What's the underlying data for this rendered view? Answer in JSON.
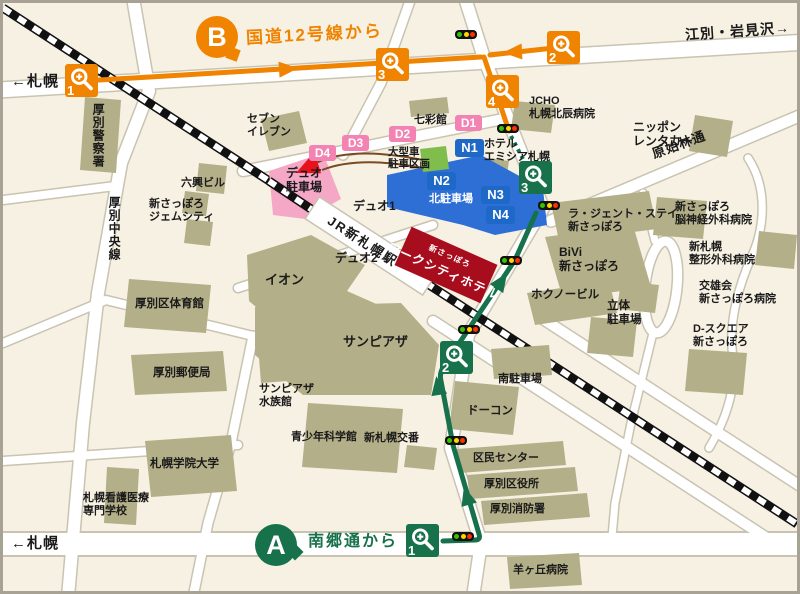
{
  "colors": {
    "background": "#F6F1E2",
    "building": "#B3AF88",
    "route_b_orange": "#F08300",
    "route_a_green": "#17714A",
    "d_badge_pink": "#F283B2",
    "n_badge_blue": "#1E68C8",
    "north_parking_blue": "#2E6FD6",
    "hotel_red": "#A80D1E",
    "large_vehicle_green": "#7FBE4C"
  },
  "directions": {
    "sapporo_top": "←札幌",
    "ebetsu_iwamizawa": "江別・岩見沢→",
    "sapporo_bottom": "←札幌"
  },
  "routes": {
    "b_badge": "B",
    "b_label": "国道12号線から",
    "a_badge": "A",
    "a_label": "南郷通から"
  },
  "markers": {
    "o1": "1",
    "o2": "2",
    "o3": "3",
    "o4": "4",
    "g1": "1",
    "g2": "2",
    "g3": "3"
  },
  "badges": {
    "d1": "D1",
    "d2": "D2",
    "d3": "D3",
    "d4": "D4",
    "n1": "N1",
    "n2": "N2",
    "n3": "N3",
    "n4": "N4"
  },
  "roads": {
    "atsubetsu_chuo": "厚別中央線",
    "genshirin": "原始林通"
  },
  "station": {
    "jr": "JR新札幌駅"
  },
  "hotel": {
    "prefix": "新さっぽろ",
    "name": "アークシティホテル"
  },
  "places": {
    "police": "厚別警察署",
    "seven": "セブン\nイレブン",
    "shichisai": "七彩館",
    "jcho": "JCHO\n札幌北辰病院",
    "nippon_rentacar": "ニッポン\nレンタカー",
    "hotel_emisia": "ホテル\nエミシア札幌",
    "large_vehicle": "大型車\n駐車区画",
    "duo_parking": "デュオ\n駐車場",
    "rokko_bldg": "六興ビル",
    "gemcity": "新さっぽろ\nジェムシティ",
    "duo1": "デュオ1",
    "duo2": "デュオ2",
    "kita_parking": "北駐車場",
    "lagent_stay": "ラ・ジェント・ステイ\n新さっぽろ",
    "bivi": "BiVi\n新さっぽろ",
    "hokuno_bldg": "ホクノービル",
    "rittai_parking": "立体\n駐車場",
    "noushinkei": "新さっぽろ\n脳神経外科病院",
    "seikei": "新札幌\n整形外科病院",
    "koyukai": "交雄会\n新さっぽろ病院",
    "d_square": "D-スクエア\n新さっぽろ",
    "aeon": "イオン",
    "taiikukan": "厚別区体育館",
    "sunpiazza": "サンピアザ",
    "yubinkyoku": "厚別郵便局",
    "aquarium": "サンピアザ\n水族館",
    "minami_parking": "南駐車場",
    "docon": "ドーコン",
    "kagakukan": "青少年科学館",
    "koban": "新札幌交番",
    "kumin_center": "区民センター",
    "kuyakusho": "厚別区役所",
    "shobosho": "厚別消防署",
    "gakuin_univ": "札幌学院大学",
    "kango_school": "札幌看護医療\n専門学校",
    "hitsujigaoka": "羊ヶ丘病院"
  }
}
